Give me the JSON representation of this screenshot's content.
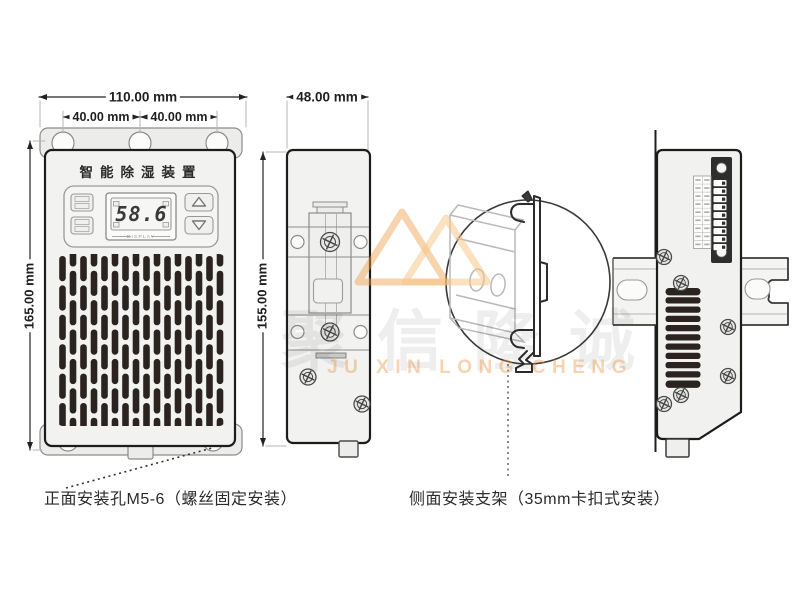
{
  "front_view": {
    "title": "智能除湿装置",
    "display": {
      "value": "58.6",
      "label": "DISPLAY"
    },
    "dims": {
      "width": "110.00 mm",
      "hole_left": "40.00 mm",
      "hole_right": "40.00 mm",
      "height": "165.00 mm"
    }
  },
  "side_view": {
    "dims": {
      "width": "48.00 mm",
      "height": "155.00 mm"
    }
  },
  "captions": {
    "front_mounting": "正面安装孔M5-6（螺丝固定安装）",
    "side_mounting": "侧面安装支架（35mm卡扣式安装）"
  },
  "watermark": {
    "cn": "聚信隆诚",
    "en": "JU XIN LONG CHENG"
  },
  "graphics": {
    "vent": {
      "columns": 16,
      "rows": 6
    },
    "louver": {
      "slats": 11
    },
    "terminal_block": {
      "terminals": 9,
      "label_rows": 9
    },
    "icons": {
      "up_button": "triangle-up",
      "down_button": "triangle-down",
      "screw": "phillips-screw-icon"
    },
    "colors": {
      "slot_dark": "#2b2320",
      "outline": "#1c1c1c",
      "body_fill": "#f2f2f0",
      "watermark_orange": "#eb913c"
    }
  }
}
